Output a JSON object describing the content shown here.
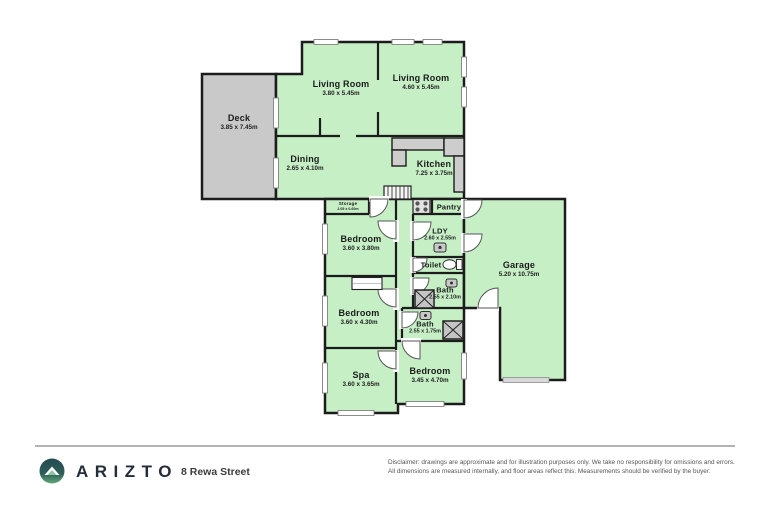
{
  "floorplan": {
    "colors": {
      "room_fill": "#c6efc6",
      "deck_fill": "#c9c9c9",
      "wall": "#1c1c1c",
      "counter_fill": "#cdcdcd",
      "garage_door": "#d9d9d9"
    },
    "rooms": {
      "living1": {
        "name": "Living Room",
        "dims": "3.80 x 5.45m"
      },
      "living2": {
        "name": "Living Room",
        "dims": "4.60 x 5.45m"
      },
      "deck": {
        "name": "Deck",
        "dims": "3.85 x 7.45m"
      },
      "dining": {
        "name": "Dining",
        "dims": "2.65 x 4.10m"
      },
      "kitchen": {
        "name": "Kitchen",
        "dims": "7.25 x 3.75m"
      },
      "storage": {
        "name": "Storage",
        "dims": "2.05 x 0.60m"
      },
      "pantry": {
        "name": "Pantry",
        "dims": ""
      },
      "bedroom1": {
        "name": "Bedroom",
        "dims": "3.60 x 3.80m"
      },
      "ldy": {
        "name": "LDY",
        "dims": "2.60 x 2.55m"
      },
      "toilet": {
        "name": "Toilet",
        "dims": ""
      },
      "garage": {
        "name": "Garage",
        "dims": "5.20 x 10.75m"
      },
      "bath1": {
        "name": "Bath",
        "dims": "2.55 x 2.10m"
      },
      "bedroom2": {
        "name": "Bedroom",
        "dims": "3.60 x 4.30m"
      },
      "bath2": {
        "name": "Bath",
        "dims": "2.55 x 1.75m"
      },
      "spa": {
        "name": "Spa",
        "dims": "3.60 x 3.65m"
      },
      "bedroom3": {
        "name": "Bedroom",
        "dims": "3.45 x 4.70m"
      }
    }
  },
  "footer": {
    "brand": "ARIZTO",
    "address": "8 Rewa Street",
    "disclaimer_line1": "Disclaimer: drawings are approximate and for illustration purposes only. We take no responsibility for omissions and errors.",
    "disclaimer_line2": "All dimensions are measured internally, and floor areas reflect this. Measurements should be verified by the buyer."
  }
}
